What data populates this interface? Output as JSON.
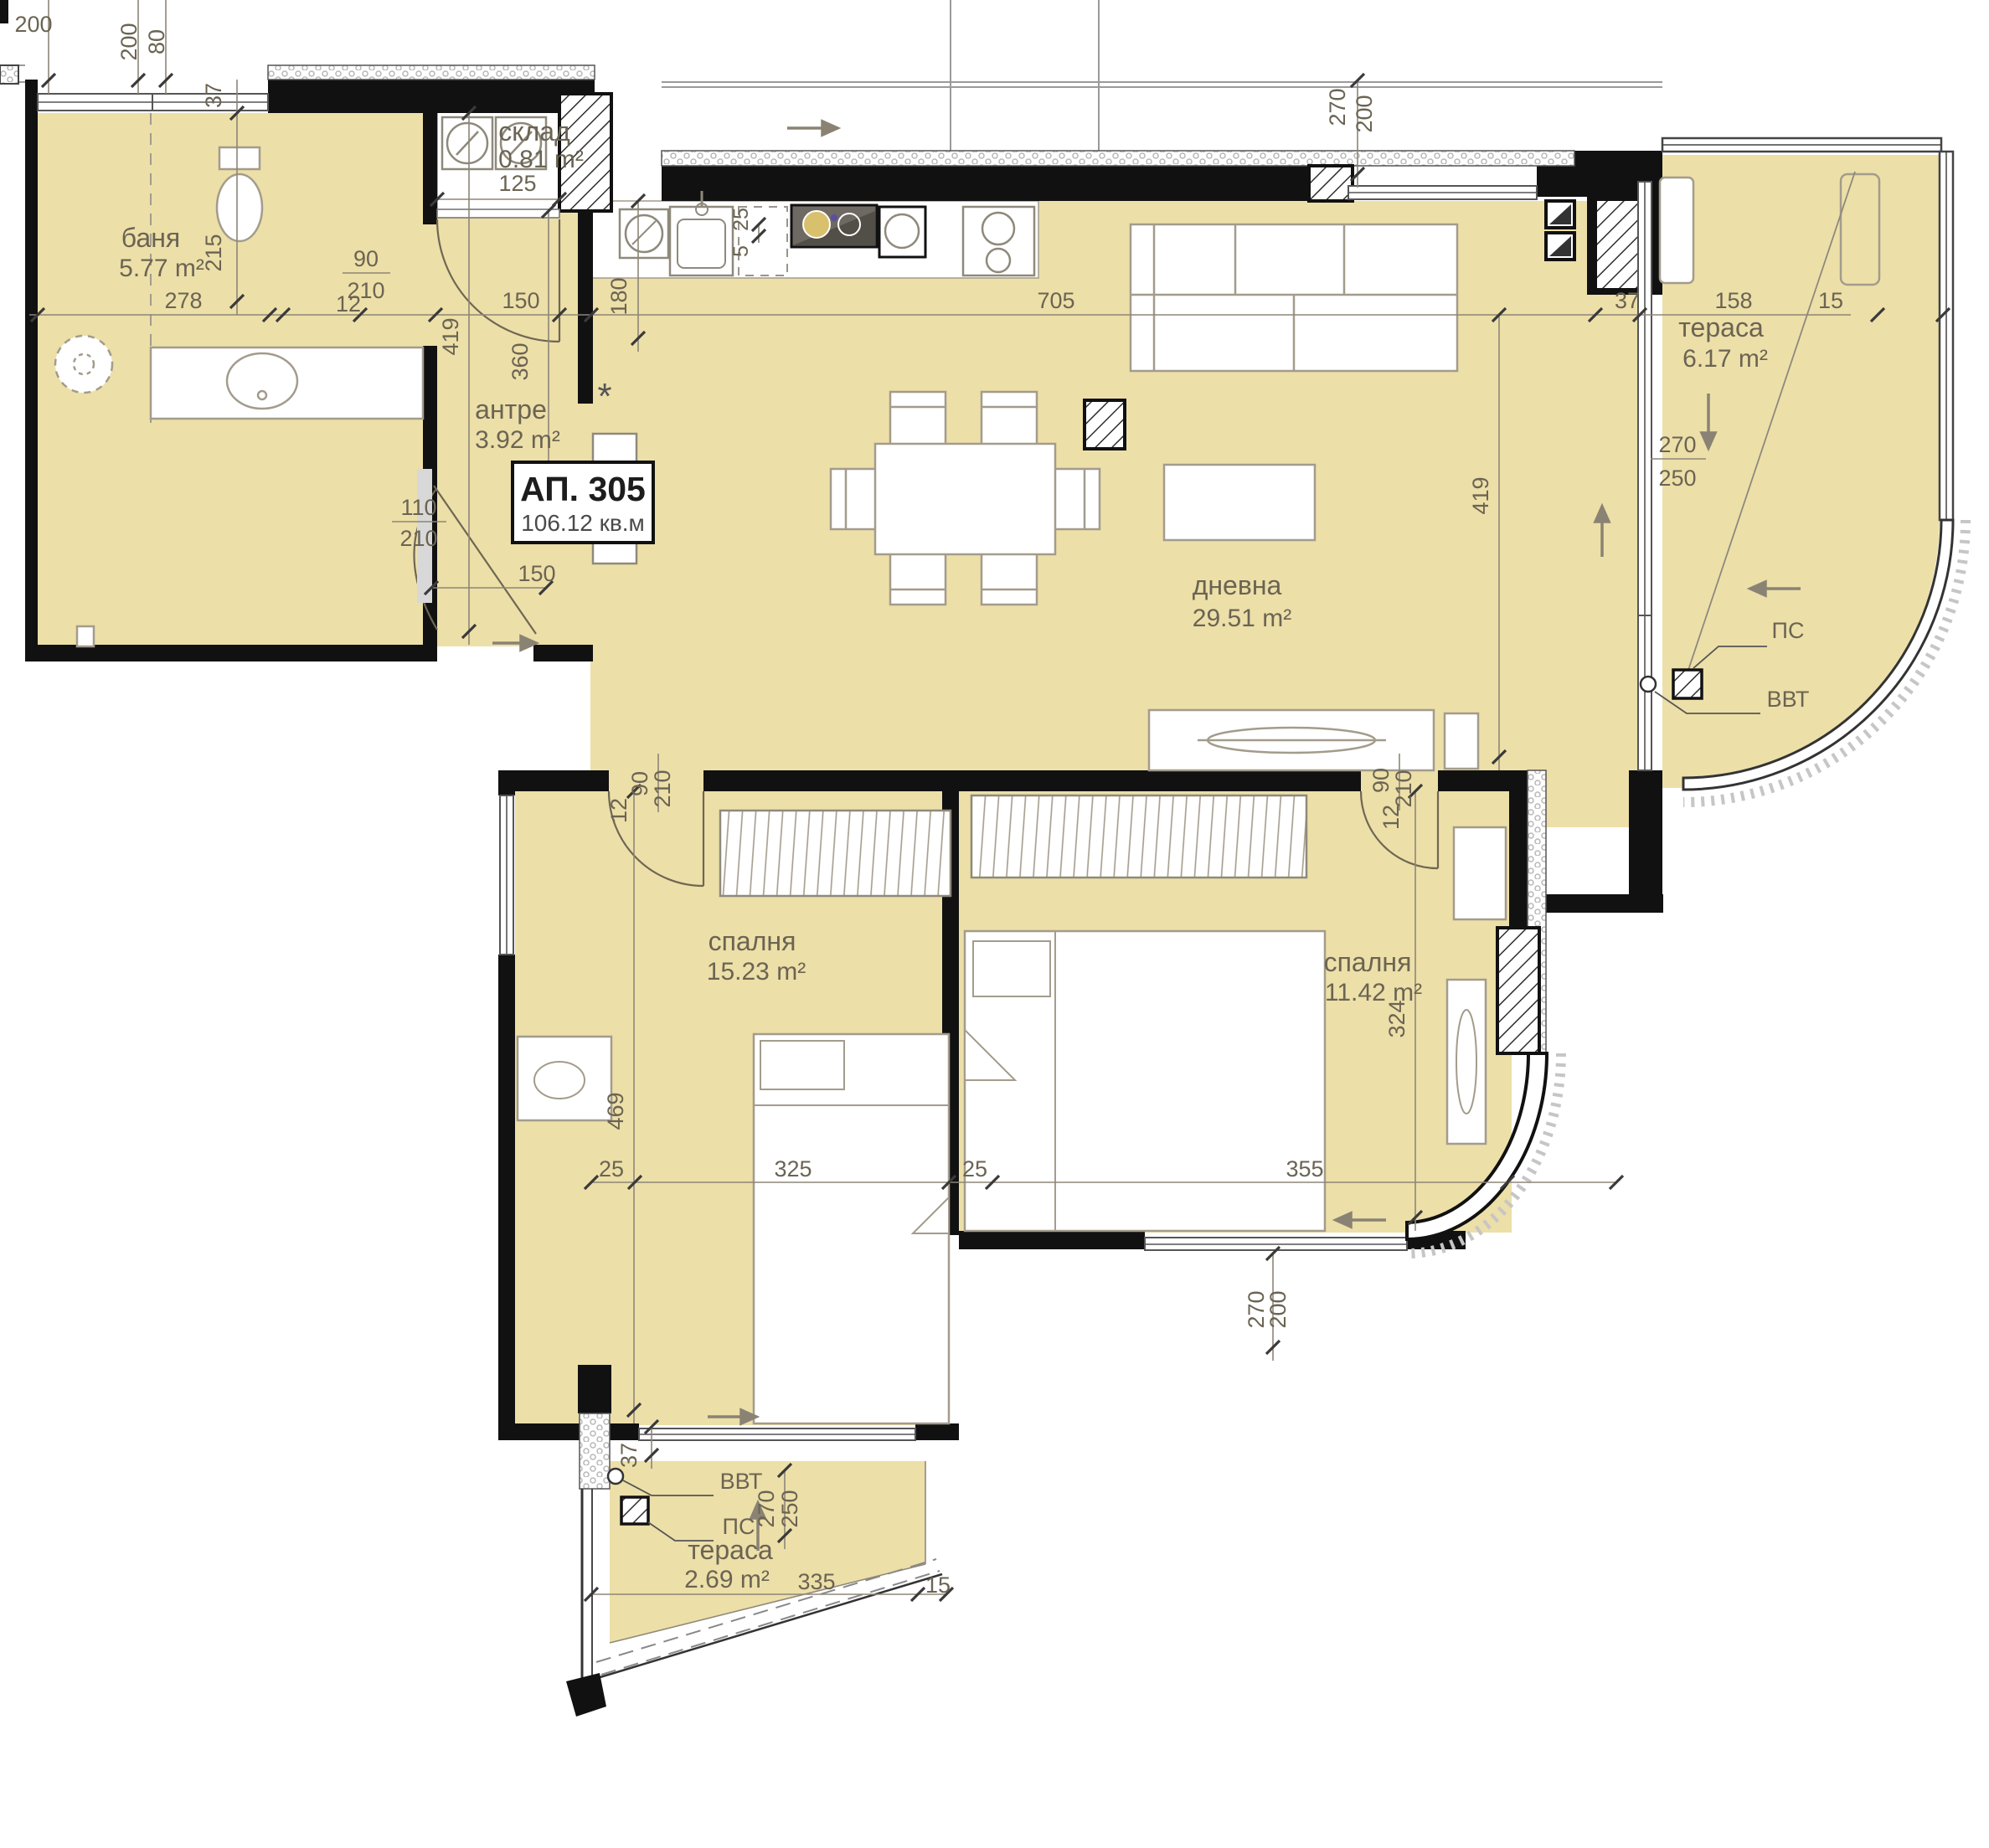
{
  "plan": {
    "apartment": {
      "number": "АП. 305",
      "area": "106.12 кв.м"
    },
    "rooms": {
      "bathroom": {
        "name": "баня",
        "area": "5.77 m²"
      },
      "storage": {
        "name": "склад",
        "area": "0.81 m²"
      },
      "hall": {
        "name": "антре",
        "area": "3.92 m²"
      },
      "living": {
        "name": "дневна",
        "area": "29.51 m²"
      },
      "terrace_right": {
        "name": "тераса",
        "area": "6.17 m²"
      },
      "bedroom_left": {
        "name": "спалня",
        "area": "15.23 m²"
      },
      "bedroom_right": {
        "name": "спалня",
        "area": "11.42 m²"
      },
      "terrace_bottom": {
        "name": "тераса",
        "area": "2.69 m²"
      }
    },
    "annotations": {
      "ps": "ПС",
      "vvt": "ВВТ",
      "asterisk": "*"
    },
    "dims": {
      "top_200": "200",
      "top_v_200": "200",
      "top_v_80": "80",
      "top_37": "37",
      "bath_278": "278",
      "bath_215": "215",
      "bathdoor_90": "90",
      "bathdoor_210": "210",
      "bathdoor_12": "12",
      "storage_125": "125",
      "halldoor_150": "150",
      "entry_110": "110",
      "entry_210": "210",
      "entry_150": "150",
      "hall_360": "360",
      "kitchen_180": "180",
      "kitchen_5": "5",
      "kitchen_25": "25",
      "living_705": "705",
      "living_419_left": "419",
      "living_419_right": "419",
      "top_270": "270",
      "top_200b": "200",
      "terr_37": "37",
      "terr_158": "158",
      "terr_15": "15",
      "terr_270": "270",
      "terr_250": "250",
      "bd1_90": "90",
      "bd1_210": "210",
      "bd1_12": "12",
      "bd1_469": "469",
      "bd2_90": "90",
      "bd2_210": "210",
      "bd2_12": "12",
      "bd2_324": "324",
      "bot_25_left": "25",
      "bot_325": "325",
      "bot_25_right": "25",
      "bot_355": "355",
      "botright_270": "270",
      "botright_200": "200",
      "bt_37": "37",
      "bt_270": "270",
      "bt_250": "250",
      "bt_335": "335",
      "bt_15": "15"
    }
  }
}
